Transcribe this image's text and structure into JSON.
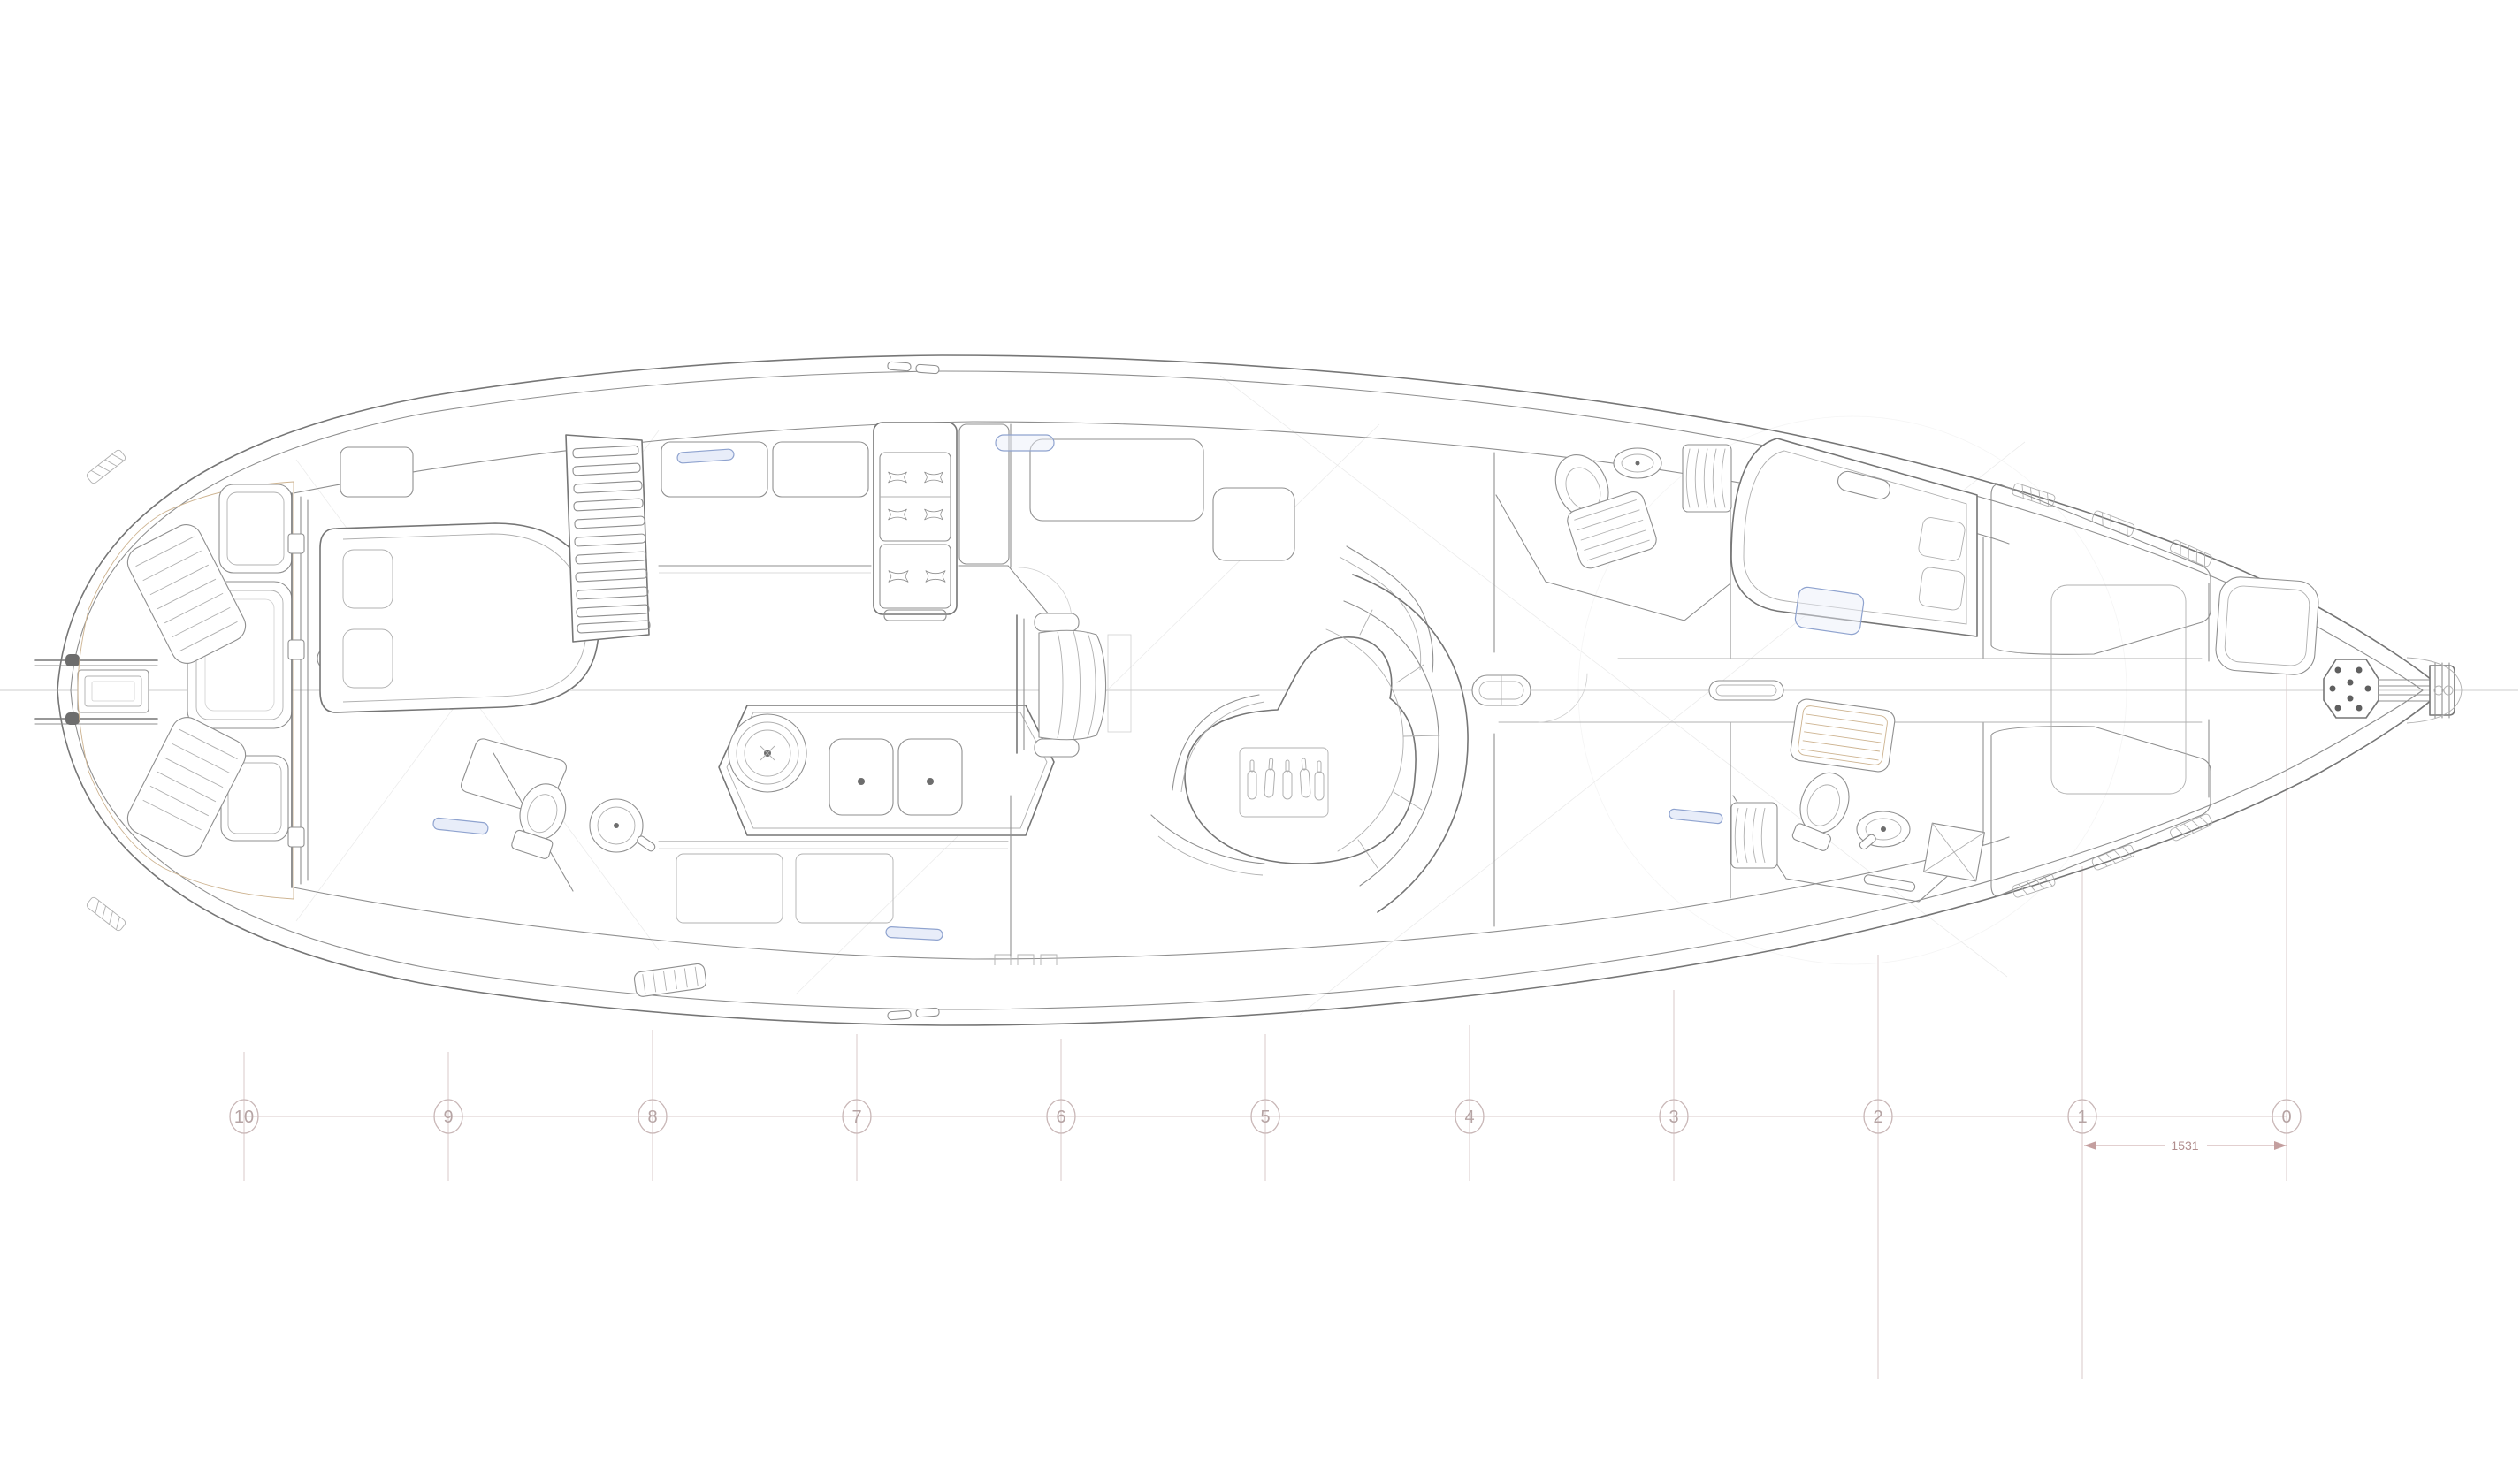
{
  "document": {
    "type": "technical-drawing",
    "subject": "sailing-yacht interior arrangement plan (overhead view)",
    "view": "plan"
  },
  "stations": {
    "labels": [
      "10",
      "9",
      "8",
      "7",
      "6",
      "5",
      "4",
      "3",
      "2",
      "1",
      "0"
    ]
  },
  "dimension": {
    "label": "1531"
  },
  "colors": {
    "background": "#ffffff",
    "linework": "#767676",
    "light_linework": "#b0b0b0",
    "teak_planking": "#cdb390",
    "quilting": "#b9bcc8",
    "accent_blue": "#8fa3cf",
    "station_marks": "#c9b7b7",
    "dimension_marks": "#c49f9f"
  }
}
